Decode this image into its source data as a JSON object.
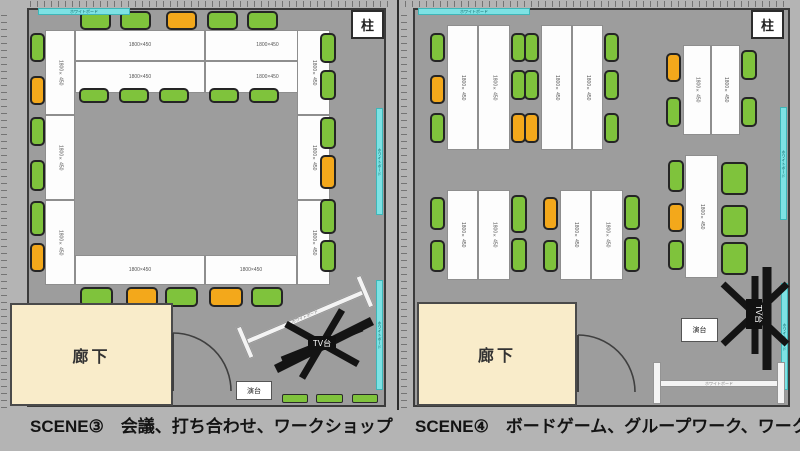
{
  "labels": {
    "pillar": "柱",
    "corridor": "廊下",
    "lectern": "演台",
    "tv_stand": "TV台",
    "table_size": "1800×450",
    "whiteboard": "ホワイトボード"
  },
  "panels": [
    {
      "caption": "SCENE③　会議、打ち合わせ、ワークショップ",
      "tables": [
        {
          "x": 75,
          "y": 30,
          "w": 130,
          "h": 31
        },
        {
          "x": 205,
          "y": 30,
          "w": 125,
          "h": 31
        },
        {
          "x": 75,
          "y": 61,
          "w": 130,
          "h": 32
        },
        {
          "x": 205,
          "y": 61,
          "w": 125,
          "h": 32
        },
        {
          "x": 45,
          "y": 30,
          "w": 30,
          "h": 85,
          "v": 1
        },
        {
          "x": 45,
          "y": 115,
          "w": 30,
          "h": 85,
          "v": 1
        },
        {
          "x": 45,
          "y": 200,
          "w": 30,
          "h": 85,
          "v": 1
        },
        {
          "x": 297,
          "y": 30,
          "w": 33,
          "h": 85,
          "v": 1
        },
        {
          "x": 297,
          "y": 115,
          "w": 33,
          "h": 85,
          "v": 1
        },
        {
          "x": 297,
          "y": 200,
          "w": 33,
          "h": 85,
          "v": 1
        },
        {
          "x": 75,
          "y": 255,
          "w": 130,
          "h": 30
        },
        {
          "x": 205,
          "y": 255,
          "w": 92,
          "h": 30
        }
      ],
      "chairs": [
        {
          "x": 80,
          "y": 11,
          "w": 31,
          "h": 19,
          "c": "g"
        },
        {
          "x": 120,
          "y": 11,
          "w": 31,
          "h": 19,
          "c": "g"
        },
        {
          "x": 166,
          "y": 11,
          "w": 31,
          "h": 19,
          "c": "o"
        },
        {
          "x": 207,
          "y": 11,
          "w": 31,
          "h": 19,
          "c": "g"
        },
        {
          "x": 247,
          "y": 11,
          "w": 31,
          "h": 19,
          "c": "g"
        },
        {
          "x": 79,
          "y": 88,
          "w": 30,
          "h": 15,
          "c": "g"
        },
        {
          "x": 119,
          "y": 88,
          "w": 30,
          "h": 15,
          "c": "g"
        },
        {
          "x": 159,
          "y": 88,
          "w": 30,
          "h": 15,
          "c": "g"
        },
        {
          "x": 209,
          "y": 88,
          "w": 30,
          "h": 15,
          "c": "g"
        },
        {
          "x": 249,
          "y": 88,
          "w": 30,
          "h": 15,
          "c": "g"
        },
        {
          "x": 30,
          "y": 33,
          "w": 15,
          "h": 29,
          "c": "g"
        },
        {
          "x": 30,
          "y": 76,
          "w": 15,
          "h": 29,
          "c": "o"
        },
        {
          "x": 30,
          "y": 117,
          "w": 15,
          "h": 29,
          "c": "g"
        },
        {
          "x": 30,
          "y": 160,
          "w": 15,
          "h": 31,
          "c": "g"
        },
        {
          "x": 30,
          "y": 201,
          "w": 15,
          "h": 35,
          "c": "g"
        },
        {
          "x": 30,
          "y": 243,
          "w": 15,
          "h": 29,
          "c": "o"
        },
        {
          "x": 320,
          "y": 33,
          "w": 16,
          "h": 30,
          "c": "g"
        },
        {
          "x": 320,
          "y": 70,
          "w": 16,
          "h": 30,
          "c": "g"
        },
        {
          "x": 320,
          "y": 117,
          "w": 16,
          "h": 32,
          "c": "g"
        },
        {
          "x": 320,
          "y": 155,
          "w": 16,
          "h": 34,
          "c": "o"
        },
        {
          "x": 320,
          "y": 199,
          "w": 16,
          "h": 35,
          "c": "g"
        },
        {
          "x": 320,
          "y": 240,
          "w": 16,
          "h": 32,
          "c": "g"
        },
        {
          "x": 80,
          "y": 287,
          "w": 33,
          "h": 20,
          "c": "g"
        },
        {
          "x": 126,
          "y": 287,
          "w": 32,
          "h": 20,
          "c": "o"
        },
        {
          "x": 165,
          "y": 287,
          "w": 33,
          "h": 20,
          "c": "g"
        },
        {
          "x": 209,
          "y": 287,
          "w": 34,
          "h": 20,
          "c": "o"
        },
        {
          "x": 251,
          "y": 287,
          "w": 32,
          "h": 20,
          "c": "g"
        }
      ],
      "cyan": [
        {
          "x": 38,
          "y": 8,
          "w": 92,
          "h": 7
        },
        {
          "x": 376,
          "y": 108,
          "w": 7,
          "h": 107,
          "vert": 1
        },
        {
          "x": 376,
          "y": 280,
          "w": 7,
          "h": 110,
          "vert": 1
        }
      ],
      "greens": [
        {
          "x": 282,
          "y": 394,
          "w": 26,
          "h": 9
        },
        {
          "x": 316,
          "y": 394,
          "w": 27,
          "h": 9
        },
        {
          "x": 352,
          "y": 394,
          "w": 26,
          "h": 9
        }
      ]
    },
    {
      "caption": "SCENE④　ボードゲーム、グループワーク、ワークショップ",
      "tables": [
        {
          "x": 447,
          "y": 25,
          "w": 31,
          "h": 125,
          "v": 1
        },
        {
          "x": 478,
          "y": 25,
          "w": 32,
          "h": 125,
          "v": 1
        },
        {
          "x": 541,
          "y": 25,
          "w": 31,
          "h": 125,
          "v": 1
        },
        {
          "x": 572,
          "y": 25,
          "w": 31,
          "h": 125,
          "v": 1
        },
        {
          "x": 683,
          "y": 45,
          "w": 28,
          "h": 90,
          "v": 1
        },
        {
          "x": 711,
          "y": 45,
          "w": 29,
          "h": 90,
          "v": 1
        },
        {
          "x": 447,
          "y": 190,
          "w": 31,
          "h": 90,
          "v": 1
        },
        {
          "x": 478,
          "y": 190,
          "w": 32,
          "h": 90,
          "v": 1
        },
        {
          "x": 560,
          "y": 190,
          "w": 31,
          "h": 90,
          "v": 1
        },
        {
          "x": 591,
          "y": 190,
          "w": 32,
          "h": 90,
          "v": 1
        },
        {
          "x": 685,
          "y": 155,
          "w": 33,
          "h": 123,
          "v": 1
        }
      ],
      "chairs": [
        {
          "x": 430,
          "y": 33,
          "w": 15,
          "h": 29,
          "c": "g"
        },
        {
          "x": 430,
          "y": 75,
          "w": 15,
          "h": 29,
          "c": "o"
        },
        {
          "x": 430,
          "y": 113,
          "w": 15,
          "h": 30,
          "c": "g"
        },
        {
          "x": 511,
          "y": 33,
          "w": 15,
          "h": 29,
          "c": "g"
        },
        {
          "x": 511,
          "y": 70,
          "w": 15,
          "h": 30,
          "c": "g"
        },
        {
          "x": 511,
          "y": 113,
          "w": 15,
          "h": 30,
          "c": "o"
        },
        {
          "x": 524,
          "y": 33,
          "w": 15,
          "h": 29,
          "c": "g"
        },
        {
          "x": 524,
          "y": 70,
          "w": 15,
          "h": 30,
          "c": "g"
        },
        {
          "x": 524,
          "y": 113,
          "w": 15,
          "h": 30,
          "c": "o"
        },
        {
          "x": 604,
          "y": 33,
          "w": 15,
          "h": 29,
          "c": "g"
        },
        {
          "x": 604,
          "y": 70,
          "w": 15,
          "h": 30,
          "c": "g"
        },
        {
          "x": 604,
          "y": 113,
          "w": 15,
          "h": 30,
          "c": "g"
        },
        {
          "x": 666,
          "y": 53,
          "w": 15,
          "h": 29,
          "c": "o"
        },
        {
          "x": 666,
          "y": 97,
          "w": 15,
          "h": 30,
          "c": "g"
        },
        {
          "x": 741,
          "y": 50,
          "w": 16,
          "h": 30,
          "c": "g"
        },
        {
          "x": 741,
          "y": 97,
          "w": 16,
          "h": 30,
          "c": "g"
        },
        {
          "x": 430,
          "y": 197,
          "w": 15,
          "h": 33,
          "c": "g"
        },
        {
          "x": 430,
          "y": 240,
          "w": 15,
          "h": 32,
          "c": "g"
        },
        {
          "x": 511,
          "y": 195,
          "w": 16,
          "h": 38,
          "c": "g"
        },
        {
          "x": 511,
          "y": 238,
          "w": 16,
          "h": 34,
          "c": "g"
        },
        {
          "x": 543,
          "y": 197,
          "w": 15,
          "h": 33,
          "c": "o"
        },
        {
          "x": 543,
          "y": 240,
          "w": 15,
          "h": 32,
          "c": "g"
        },
        {
          "x": 624,
          "y": 195,
          "w": 16,
          "h": 35,
          "c": "g"
        },
        {
          "x": 624,
          "y": 237,
          "w": 16,
          "h": 35,
          "c": "g"
        },
        {
          "x": 668,
          "y": 160,
          "w": 16,
          "h": 32,
          "c": "g"
        },
        {
          "x": 668,
          "y": 203,
          "w": 16,
          "h": 29,
          "c": "o"
        },
        {
          "x": 668,
          "y": 240,
          "w": 16,
          "h": 30,
          "c": "g"
        },
        {
          "x": 721,
          "y": 162,
          "w": 27,
          "h": 33,
          "c": "g"
        },
        {
          "x": 721,
          "y": 205,
          "w": 27,
          "h": 32,
          "c": "g"
        },
        {
          "x": 721,
          "y": 242,
          "w": 27,
          "h": 33,
          "c": "g"
        }
      ],
      "cyan": [
        {
          "x": 418,
          "y": 8,
          "w": 112,
          "h": 7
        },
        {
          "x": 780,
          "y": 107,
          "w": 7,
          "h": 113,
          "vert": 1
        },
        {
          "x": 781,
          "y": 283,
          "w": 7,
          "h": 107,
          "vert": 1
        }
      ],
      "greens": []
    }
  ]
}
